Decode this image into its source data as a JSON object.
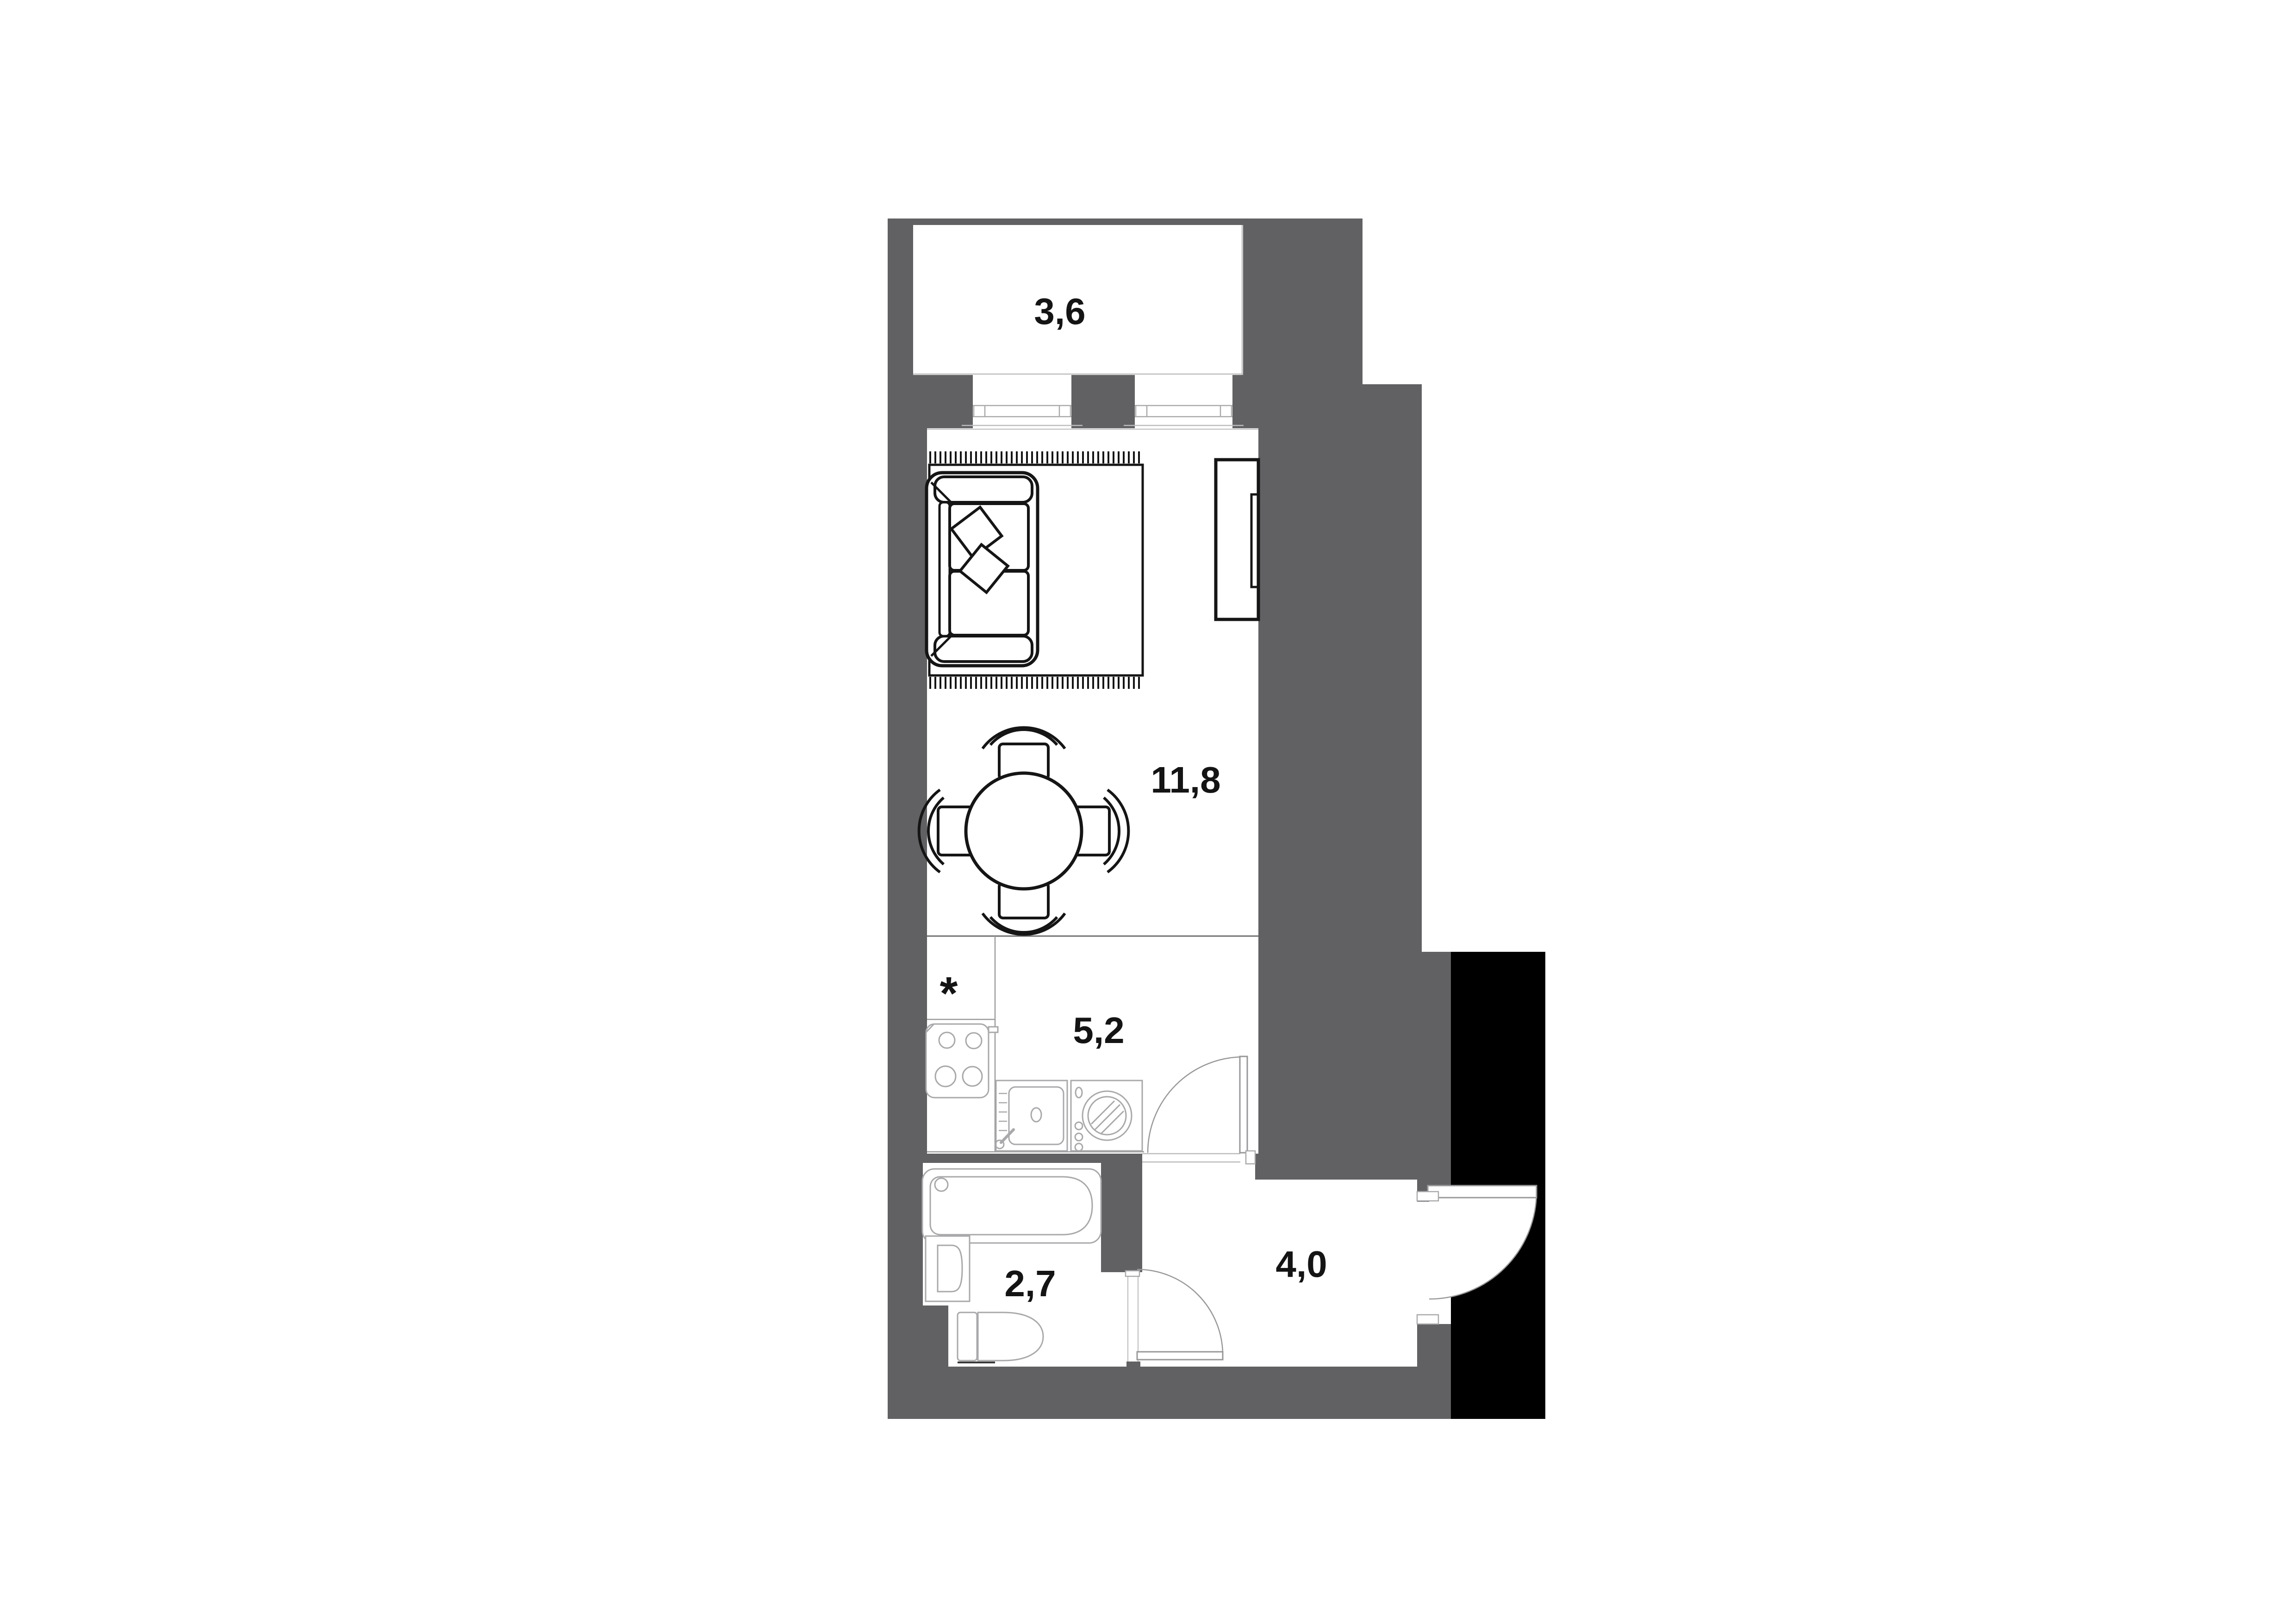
{
  "title": "Studio apartment floor plan",
  "colors": {
    "page_bg": "#ffffff",
    "wall": "#616163",
    "floor": "#ffffff",
    "shaft": "#000000",
    "furniture_dark": "#151515",
    "fixture_light": "#a9a9ab",
    "frame_light": "#bcbcbe",
    "door_line": "#98989a",
    "label": "#141414"
  },
  "plan": {
    "rooms": [
      {
        "id": "balcony",
        "area_label": "3,6"
      },
      {
        "id": "living-room",
        "area_label": "11,8"
      },
      {
        "id": "kitchen",
        "area_label": "5,2"
      },
      {
        "id": "bathroom",
        "area_label": "2,7"
      },
      {
        "id": "hallway",
        "area_label": "4,0"
      }
    ],
    "kitchen_footnote_marker": "*",
    "elements": [
      "balcony-glazing",
      "window",
      "area-rug",
      "sofa",
      "pillow",
      "tv-cabinet",
      "tv",
      "dining-table",
      "dining-chair",
      "cooktop",
      "kitchen-sink",
      "washing-machine",
      "bathtub",
      "washbasin",
      "toilet",
      "kitchen-door-swing",
      "bathroom-door-swing",
      "entrance-door-swing",
      "shaft-block"
    ]
  }
}
